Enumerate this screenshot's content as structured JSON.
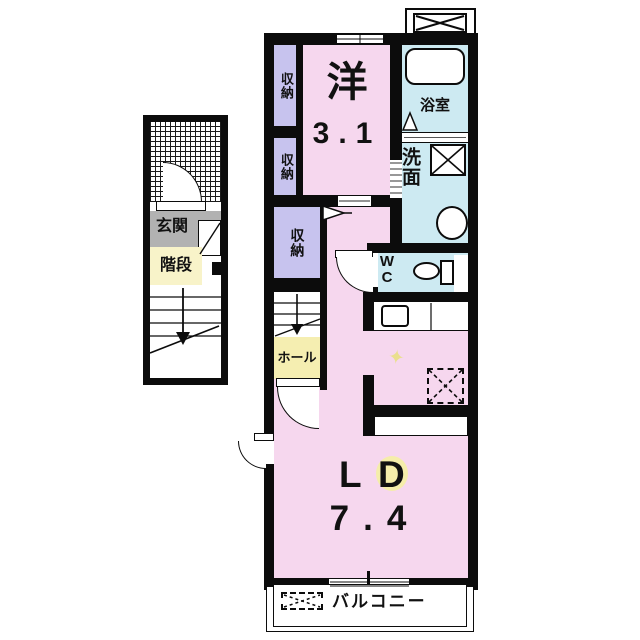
{
  "labels": {
    "closet_top": "収納",
    "closet_middle": "収納",
    "closet_lower": "収納",
    "western_room": "洋",
    "western_room_size": "3.1",
    "bath": "浴室",
    "washroom": "洗面",
    "wc_w": "W",
    "wc_c": "C",
    "hall": "ホール",
    "entrance": "玄関",
    "stairs": "階段",
    "ld_l": "L",
    "ld_d": "D",
    "ld_size": "7.4",
    "balcony": "バルコニー"
  },
  "icons": {
    "sparkle": "✦"
  },
  "colors": {
    "room_pink": "#f6d7ee",
    "closet_lavender": "#c7c3ee",
    "wet_area_blue": "#cdeaf2",
    "hall_yellow": "#f5eeb1",
    "stairs_label_yellow": "#f8f3c9",
    "entrance_gray": "#b2b2b2",
    "highlight_yellow": "#f5edaa",
    "wall_black": "#0c0c0c"
  }
}
